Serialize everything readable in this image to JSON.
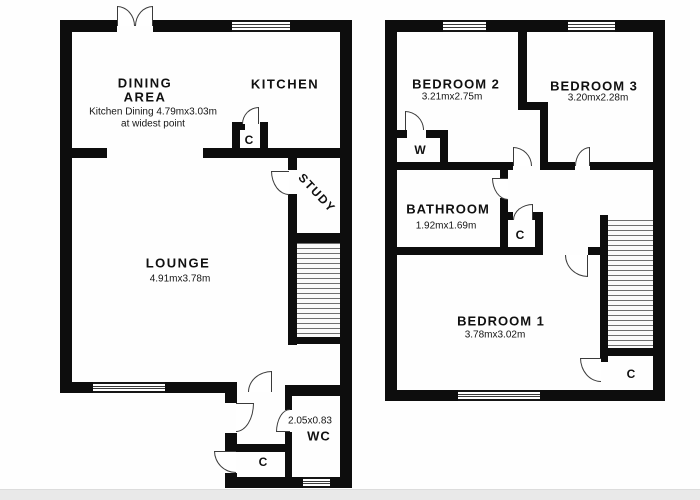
{
  "ground_floor": {
    "dining_line1": "DINING",
    "dining_line2": "AREA",
    "dining_note1": "Kitchen Dining 4.79mx3.03m",
    "dining_note2": "at widest point",
    "kitchen": "KITCHEN",
    "kitchen_closet": "C",
    "study": "STUDY",
    "lounge": "LOUNGE",
    "lounge_dims": "4.91mx3.78m",
    "wc_dims": "2.05x0.83",
    "wc": "WC",
    "hall_closet": "C"
  },
  "first_floor": {
    "bedroom2": "BEDROOM 2",
    "bedroom2_dims": "3.21mx2.75m",
    "bedroom3": "BEDROOM 3",
    "bedroom3_dims": "3.20mx2.28m",
    "wardrobe": "W",
    "bathroom": "BATHROOM",
    "bathroom_dims": "1.92mx1.69m",
    "landing_closet": "C",
    "bedroom1": "BEDROOM 1",
    "bedroom1_dims": "3.78mx3.02m",
    "bedroom1_closet": "C"
  },
  "colors": {
    "wall": "#0d0d0d",
    "background": "#ffffff",
    "stair_line": "#6f6f6f",
    "scan_strip": "#e9e9e9"
  }
}
